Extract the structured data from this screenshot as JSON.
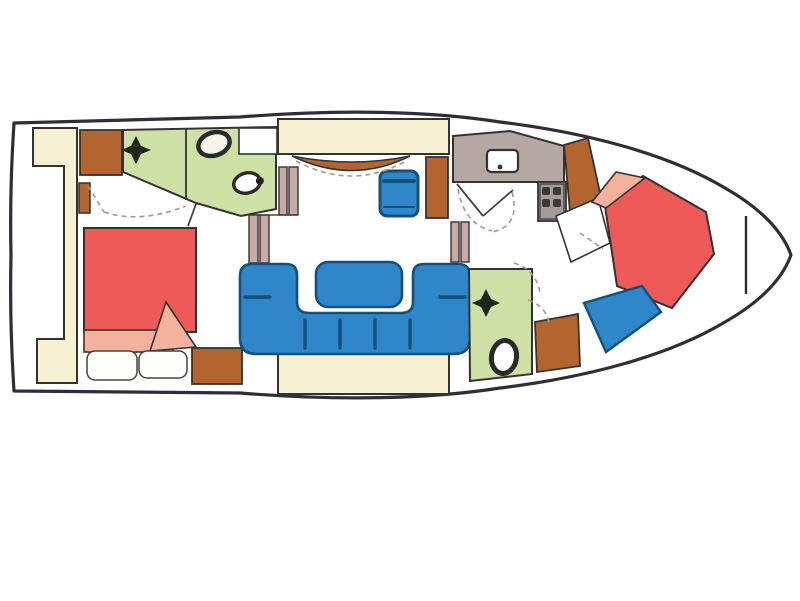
{
  "image": {
    "kind": "boat-interior-floorplan",
    "orientation": "bow-right"
  },
  "palette": {
    "hull_outline": "#2e2e38",
    "wall": "#333333",
    "bed_red": "#ee5a58",
    "bedding_pink": "#f4b29c",
    "upholstery_blue": "#2f87c9",
    "upholstery_dark_blue": "#14507c",
    "wet_room_green": "#cfe0a6",
    "floor_cream": "#f6f1d2",
    "cabinet_brown": "#b4652f",
    "galley_taupe": "#b5a8a4",
    "stove_taupe": "#a89b97",
    "pillar_mauve": "#c9aba6",
    "appliance_dark": "#3a3a3a",
    "fixture_dark": "#20251f",
    "door_swing_gray": "#9a9a9a",
    "toilet_cream": "#f7f5ea",
    "white": "#ffffff"
  },
  "icons": {
    "aft_head_toilet": "toilet-icon",
    "aft_head_basin": "basin-icon",
    "aft_head_faucet": "faucet-icon",
    "fwd_head_toilet": "toilet-icon",
    "fwd_head_faucet": "faucet-icon",
    "galley_sink": "sink-icon",
    "galley_stove": "stove-burners-icon",
    "helm_seat": "helm-seat-icon",
    "salon_table": "table-icon",
    "bow_locker": "bow-bulkhead"
  }
}
